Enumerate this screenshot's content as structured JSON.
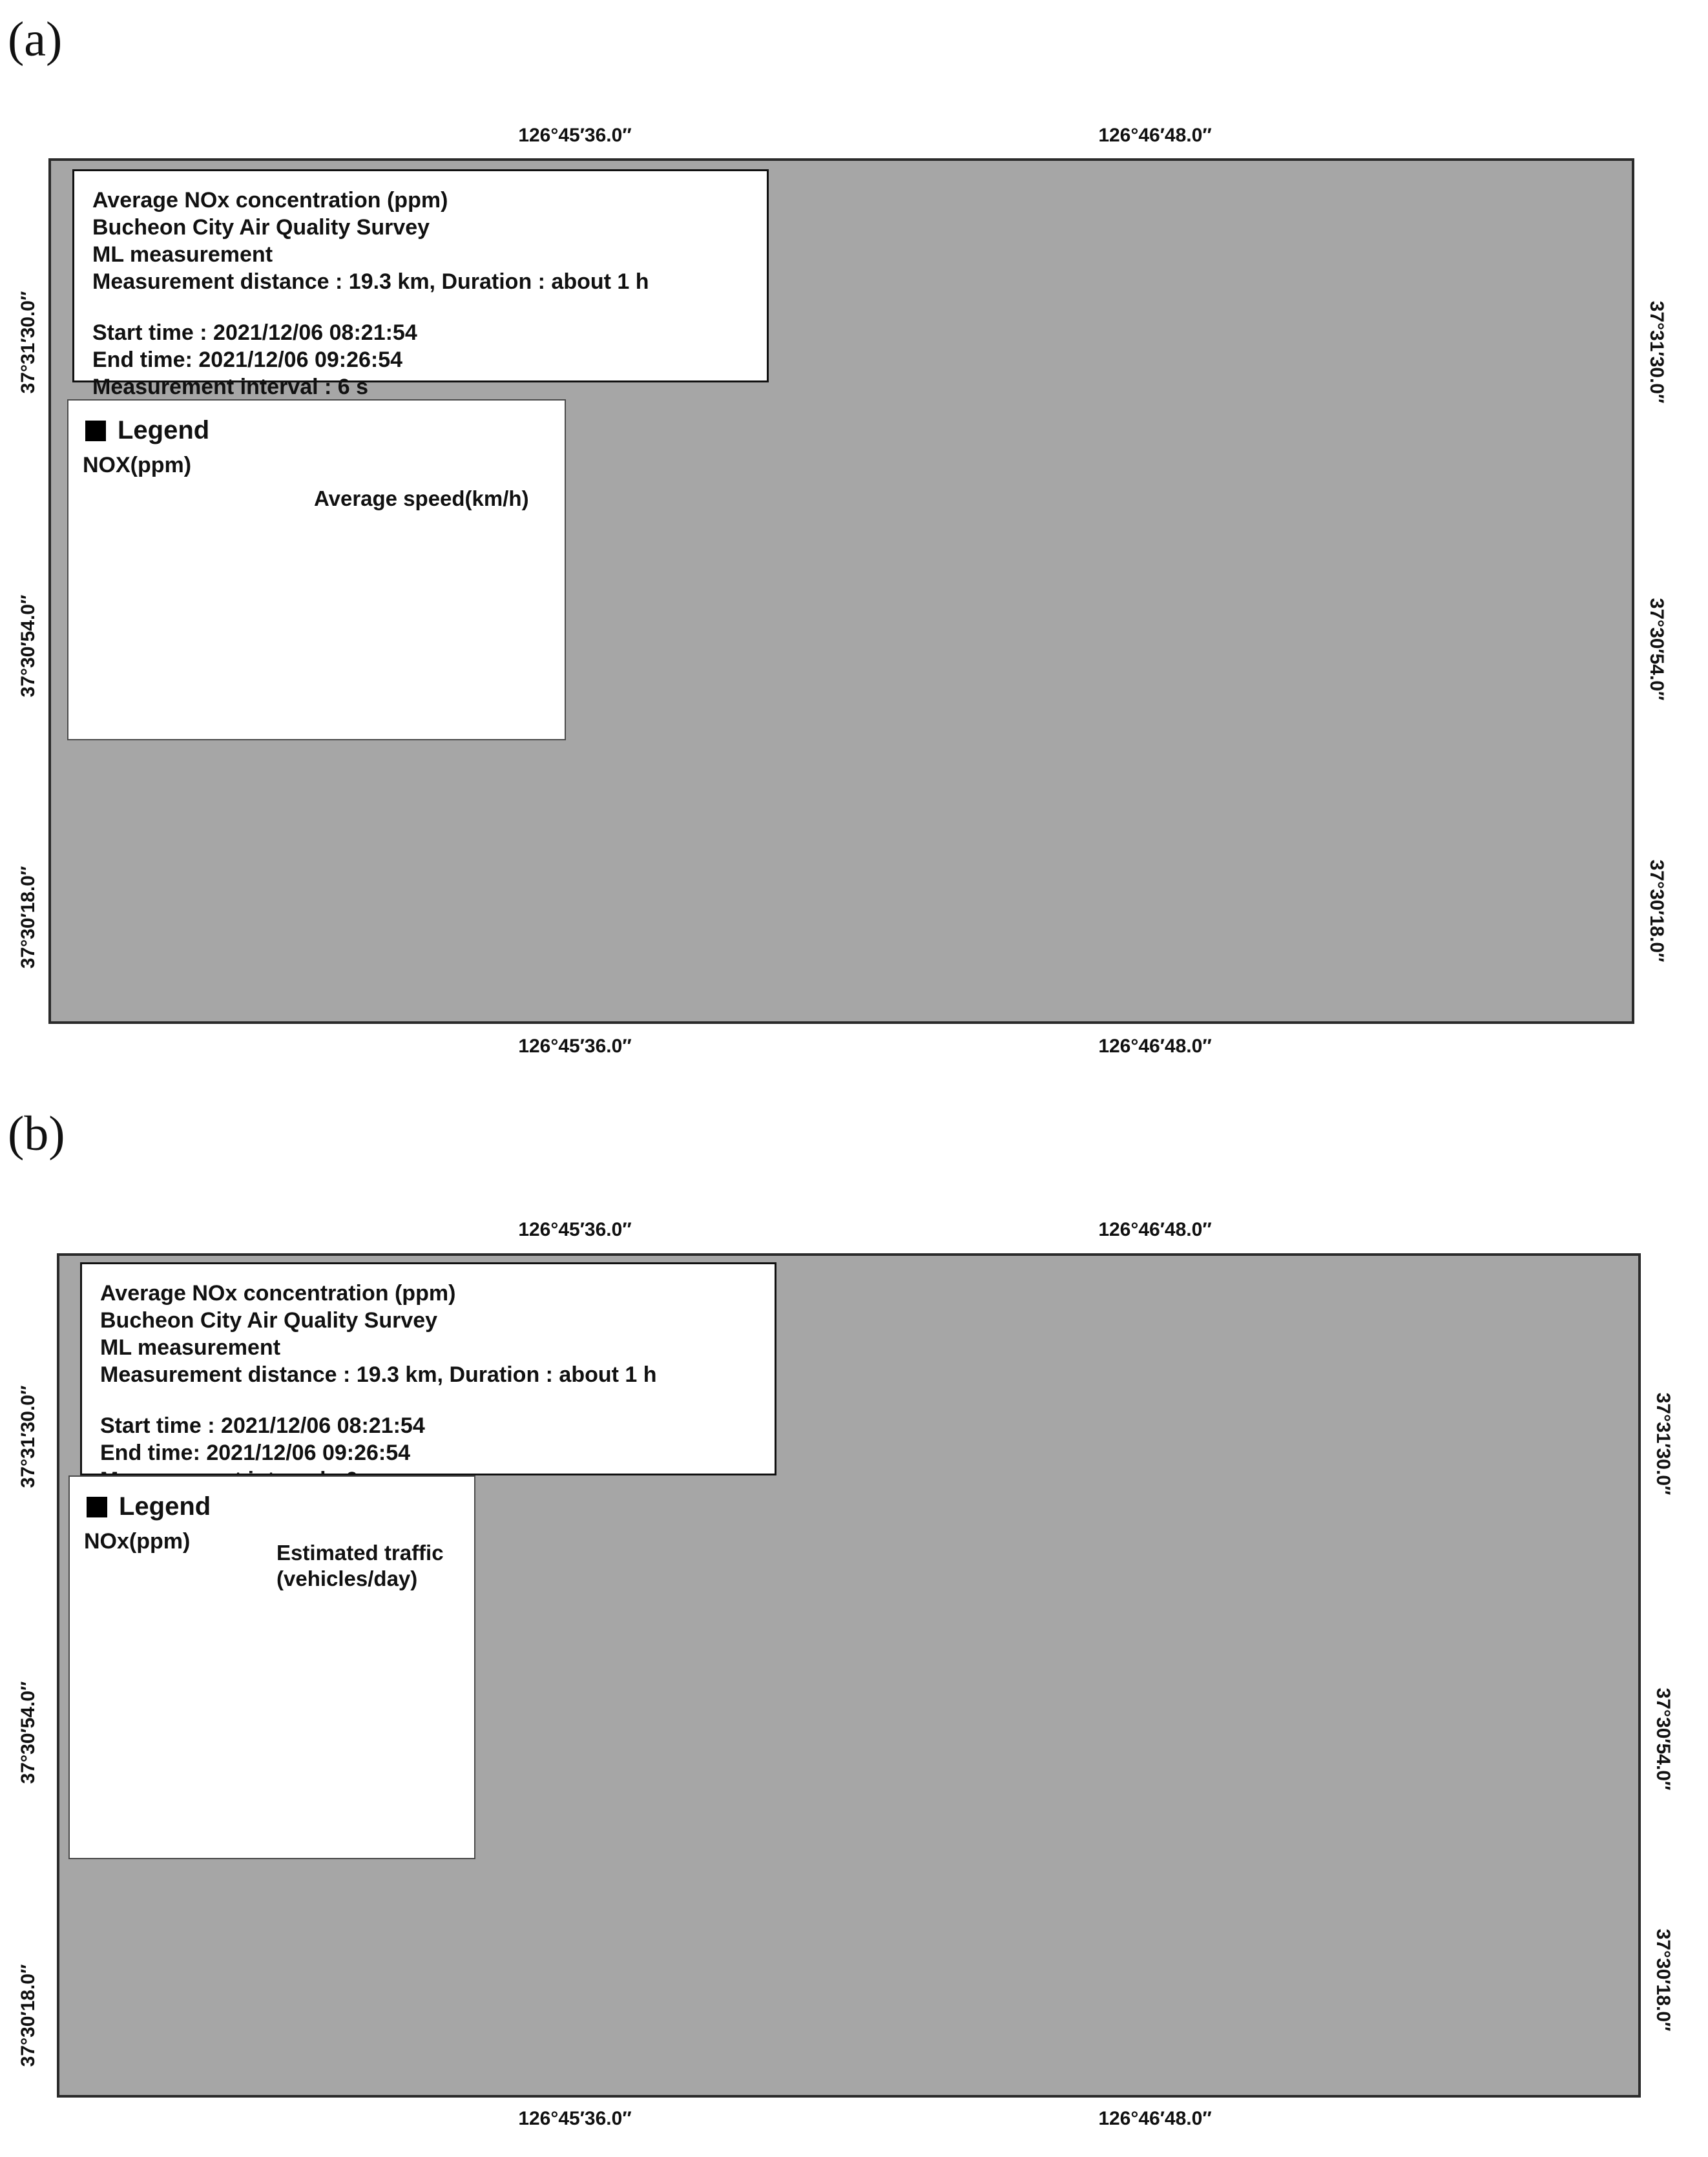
{
  "figure": {
    "panel_a_label": "(a)",
    "panel_b_label": "(b)"
  },
  "info_box": {
    "line1": "Average NOx concentration (ppm)",
    "line2": "Bucheon City Air Quality Survey",
    "line3": "ML measurement",
    "line4": "Measurement distance : 19.3 km, Duration : about 1 h",
    "line5": "Start time : 2021/12/06 08:21:54",
    "line6": "End time: 2021/12/06 09:26:54",
    "line7": "Measurement interval : 6 s"
  },
  "axes": {
    "x_labels": [
      "126°45′36.0″",
      "126°46′48.0″"
    ],
    "y_labels": [
      "37°31′30.0″",
      "37°30′54.0″",
      "37°30′18.0″"
    ]
  },
  "nox_classes": [
    {
      "range": "0.049 – 0.135",
      "color": "#2b6ca3"
    },
    {
      "range": "0.135 – 0.221",
      "color": "#4189bd"
    },
    {
      "range": "0.221 – 0.308",
      "color": "#6fa8cc"
    },
    {
      "range": "0.308 – 0.394",
      "color": "#9fc4db"
    },
    {
      "range": "0.394 – 0.48",
      "color": "#c6d9e6"
    },
    {
      "range": "0.48 – 0.567",
      "color": "#e0e9ec"
    },
    {
      "range": "0.567 – 0.653",
      "color": "#ecf1e0"
    },
    {
      "range": "0.653 – 0.739",
      "color": "#eff5cd"
    },
    {
      "range": "0.739 – 0.825",
      "color": "#f6f2c0"
    },
    {
      "range": "0.825 – 0.912",
      "color": "#eadfa0"
    },
    {
      "range": "0.912 – 0.998",
      "color": "#f2c890"
    },
    {
      "range": "0.998 – 1.084",
      "color": "#f0a870"
    },
    {
      "range": "1.084 – 1.171",
      "color": "#e8815c"
    },
    {
      "range": "1.171 – 1.257",
      "color": "#e25344"
    },
    {
      "range": "1.257 – 1.343",
      "color": "#c5212b"
    }
  ],
  "legend_a": {
    "title": "Legend",
    "nox_label": "NOX(ppm)",
    "speed_label": "Average speed(km/h)",
    "speed_items": [
      {
        "range": "0 – 30 km/h",
        "color": "#d8232e"
      },
      {
        "range": "30 – 40 km/h",
        "color": "#f0a050"
      },
      {
        "range": "40 – 60 km/h",
        "color": "#f2f4b8"
      },
      {
        "range": "60 – 80 km/h",
        "color": "#a8d178"
      },
      {
        "range": "80 km/h higher",
        "color": "#11994a"
      }
    ]
  },
  "legend_b": {
    "title": "Legend",
    "nox_label": "NOx(ppm)",
    "traffic_label": "Estimated traffic",
    "traffic_sublabel": "(vehicles/day)",
    "traffic_items": [
      {
        "range": "0 – 799",
        "color": "#11994a"
      },
      {
        "range": "799 – 1323",
        "color": "#a8d178"
      },
      {
        "range": "1323 – 1953",
        "color": "#f2f4b8"
      },
      {
        "range": "1953 – 3755",
        "color": "#f0a050"
      },
      {
        "range": "3755 – 7463",
        "color": "#d8232e"
      }
    ]
  },
  "districts": [
    "ung-dong",
    "Nae-dong",
    "Ojeong-dong",
    "YakDae-dong",
    "DoDang-dong",
    "YeoWol-dong",
    "Sang-dong",
    "Joong-dong",
    "ChunUi-dong"
  ],
  "scale_bar": {
    "labels": [
      "0",
      "500",
      "1,000 m"
    ]
  },
  "compass": {
    "label": "N"
  },
  "road_palette": {
    "red": "#d8232e",
    "orange": "#f0a050",
    "pale_yellow": "#f2f4b8",
    "light_green": "#a8d178",
    "green": "#11994a",
    "core": "#f7f2bb"
  },
  "map_colors": {
    "survey_area_fill": "#cd8a42",
    "satellite_base": "#a6a6a6",
    "grid_line": "#1a1a1a"
  }
}
